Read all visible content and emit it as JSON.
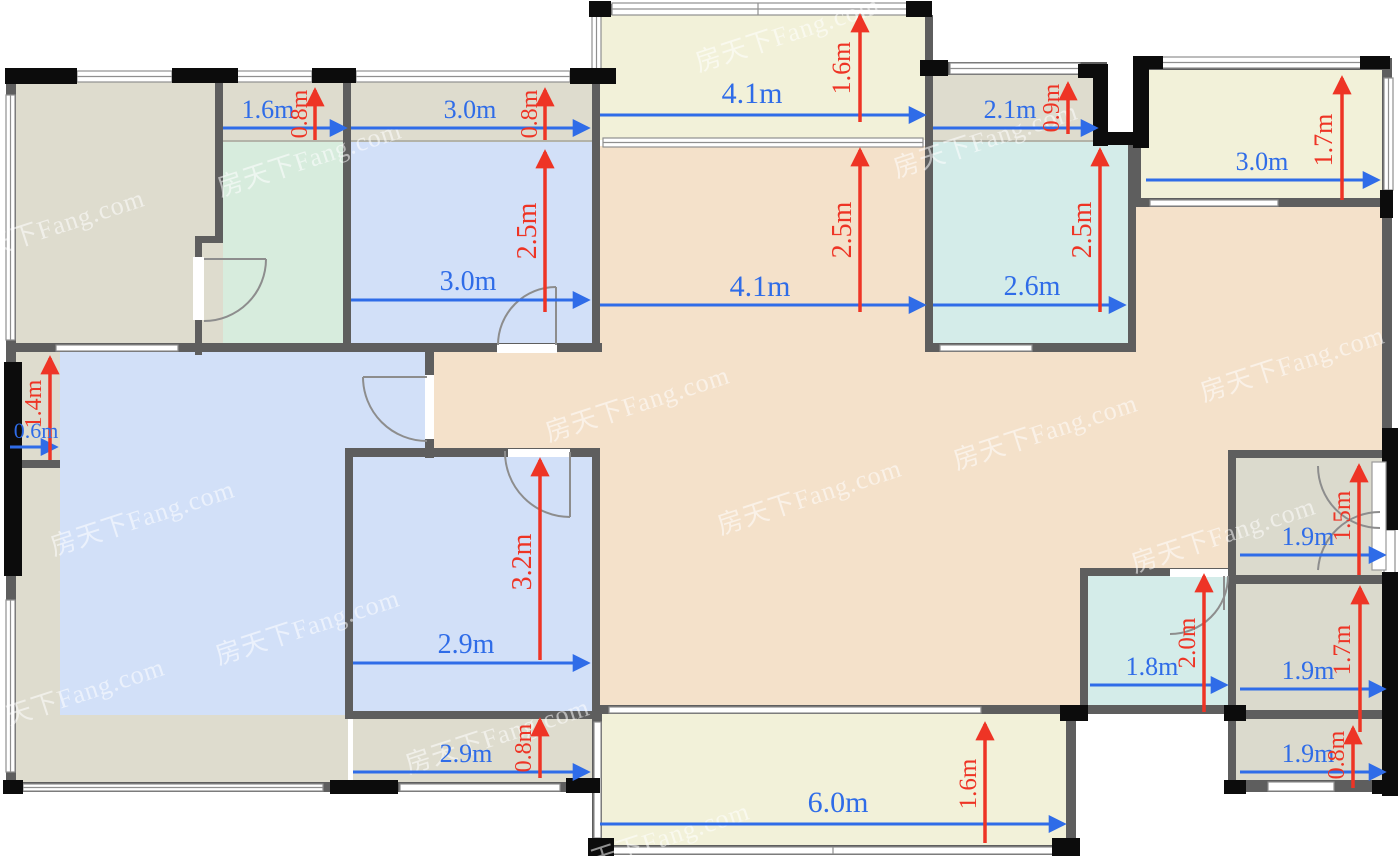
{
  "watermark": {
    "text": "房天下Fang.com"
  },
  "palette": {
    "wall_gray": "#5e5e5e",
    "wall_black": "#0c0c0c",
    "window_line": "#8f8f8f",
    "dim_blue": "#2f6ce8",
    "dim_red": "#ee3425",
    "room_tan": "#dedcce",
    "room_green": "#d7ecdd",
    "room_blue": "#d2e0f8",
    "room_teal": "#d4ece9",
    "room_cream": "#f2f1d9",
    "room_peach": "#f4e1ca",
    "room_gray": "#dbdacd"
  },
  "dimensions": {
    "horizontal": [
      {
        "label": "1.6m"
      },
      {
        "label": "3.0m"
      },
      {
        "label": "4.1m"
      },
      {
        "label": "2.1m"
      },
      {
        "label": "3.0m"
      },
      {
        "label": "3.0m"
      },
      {
        "label": "4.1m"
      },
      {
        "label": "2.6m"
      },
      {
        "label": "0.6m"
      },
      {
        "label": "1.9m"
      },
      {
        "label": "2.9m"
      },
      {
        "label": "1.8m"
      },
      {
        "label": "1.9m"
      },
      {
        "label": "2.9m"
      },
      {
        "label": "1.9m"
      },
      {
        "label": "6.0m"
      }
    ],
    "vertical": [
      {
        "label": "0.8m"
      },
      {
        "label": "0.8m"
      },
      {
        "label": "1.6m"
      },
      {
        "label": "0.9m"
      },
      {
        "label": "1.7m"
      },
      {
        "label": "2.5m"
      },
      {
        "label": "2.5m"
      },
      {
        "label": "2.5m"
      },
      {
        "label": "1.4m"
      },
      {
        "label": "3.2m"
      },
      {
        "label": "1.5m"
      },
      {
        "label": "2.0m"
      },
      {
        "label": "1.7m"
      },
      {
        "label": "0.8m"
      },
      {
        "label": "0.8m"
      },
      {
        "label": "1.6m"
      }
    ]
  }
}
